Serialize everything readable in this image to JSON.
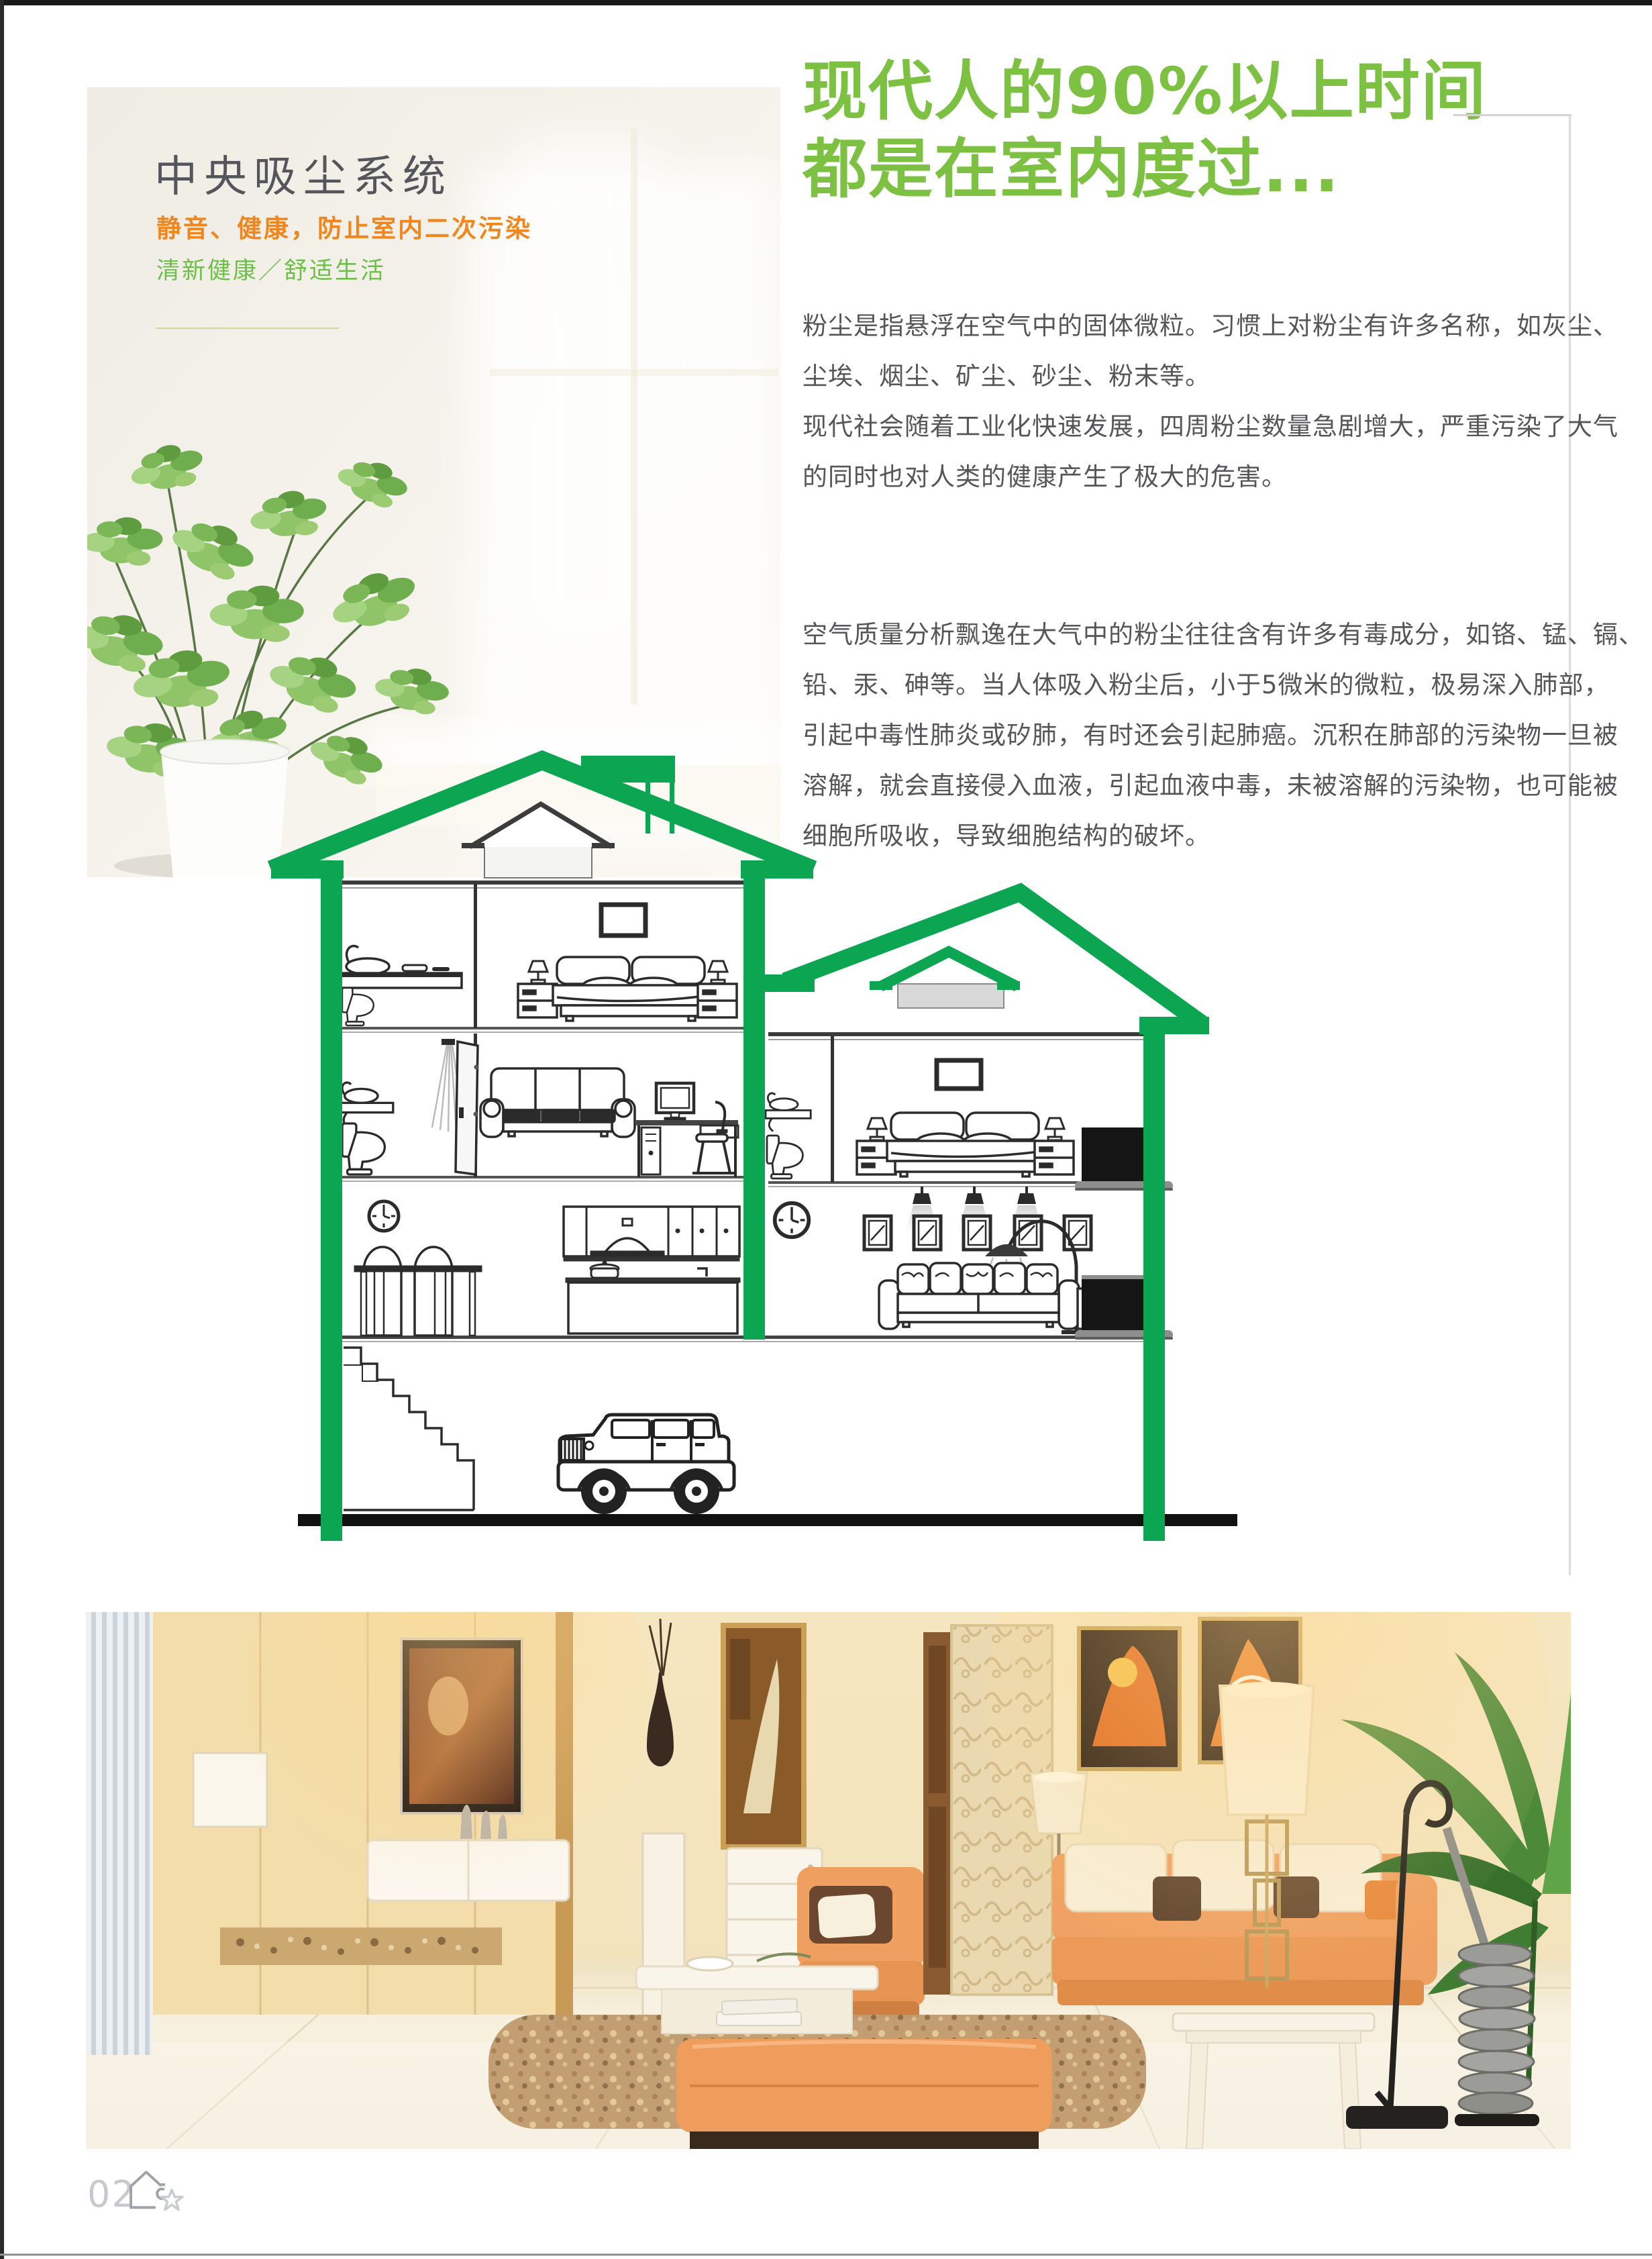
{
  "page": {
    "left_panel": {
      "title": "中央吸尘系统",
      "subtitle_orange": "静音、健康，防止室内二次污染",
      "subtitle_green": "清新健康／舒适生活"
    },
    "headline": {
      "line1": "现代人的90%以上时间",
      "line2": "都是在室内度过..."
    },
    "body": {
      "paragraph1_lines": [
        "粉尘是指悬浮在空气中的固体微粒。习惯上对粉尘有许多名称，如灰尘、",
        "尘埃、烟尘、矿尘、砂尘、粉末等。",
        "现代社会随着工业化快速发展，四周粉尘数量急剧增大，严重污染了大气",
        "的同时也对人类的健康产生了极大的危害。"
      ],
      "paragraph2_lines": [
        "空气质量分析飘逸在大气中的粉尘往往含有许多有毒成分，如铬、锰、镉、",
        "铅、汞、砷等。当人体吸入粉尘后，小于5微米的微粒，极易深入肺部，",
        "引起中毒性肺炎或矽肺，有时还会引起肺癌。沉积在肺部的污染物一旦被",
        "溶解，就会直接侵入血液，引起血液中毒，未被溶解的污染物，也可能被",
        "细胞所吸收，导致细胞结构的破坏。"
      ]
    },
    "footer": {
      "page_number": "02",
      "icons": [
        "house-icon",
        "star-icon"
      ]
    },
    "illustrations": {
      "hero_photo": "indoor plant by bright window",
      "diagram": "two-house cutaway with central vacuum units",
      "room_photo": "warm living room with central vacuum cleaner"
    },
    "colors": {
      "headline_green": "#7cc142",
      "diagram_green": "#0ca551",
      "subtitle_orange": "#f0861d",
      "subtitle_green": "#6cbf47",
      "title_gray": "#54565b",
      "body_gray": "#56565a",
      "footer_gray": "#c6c9cd"
    }
  }
}
